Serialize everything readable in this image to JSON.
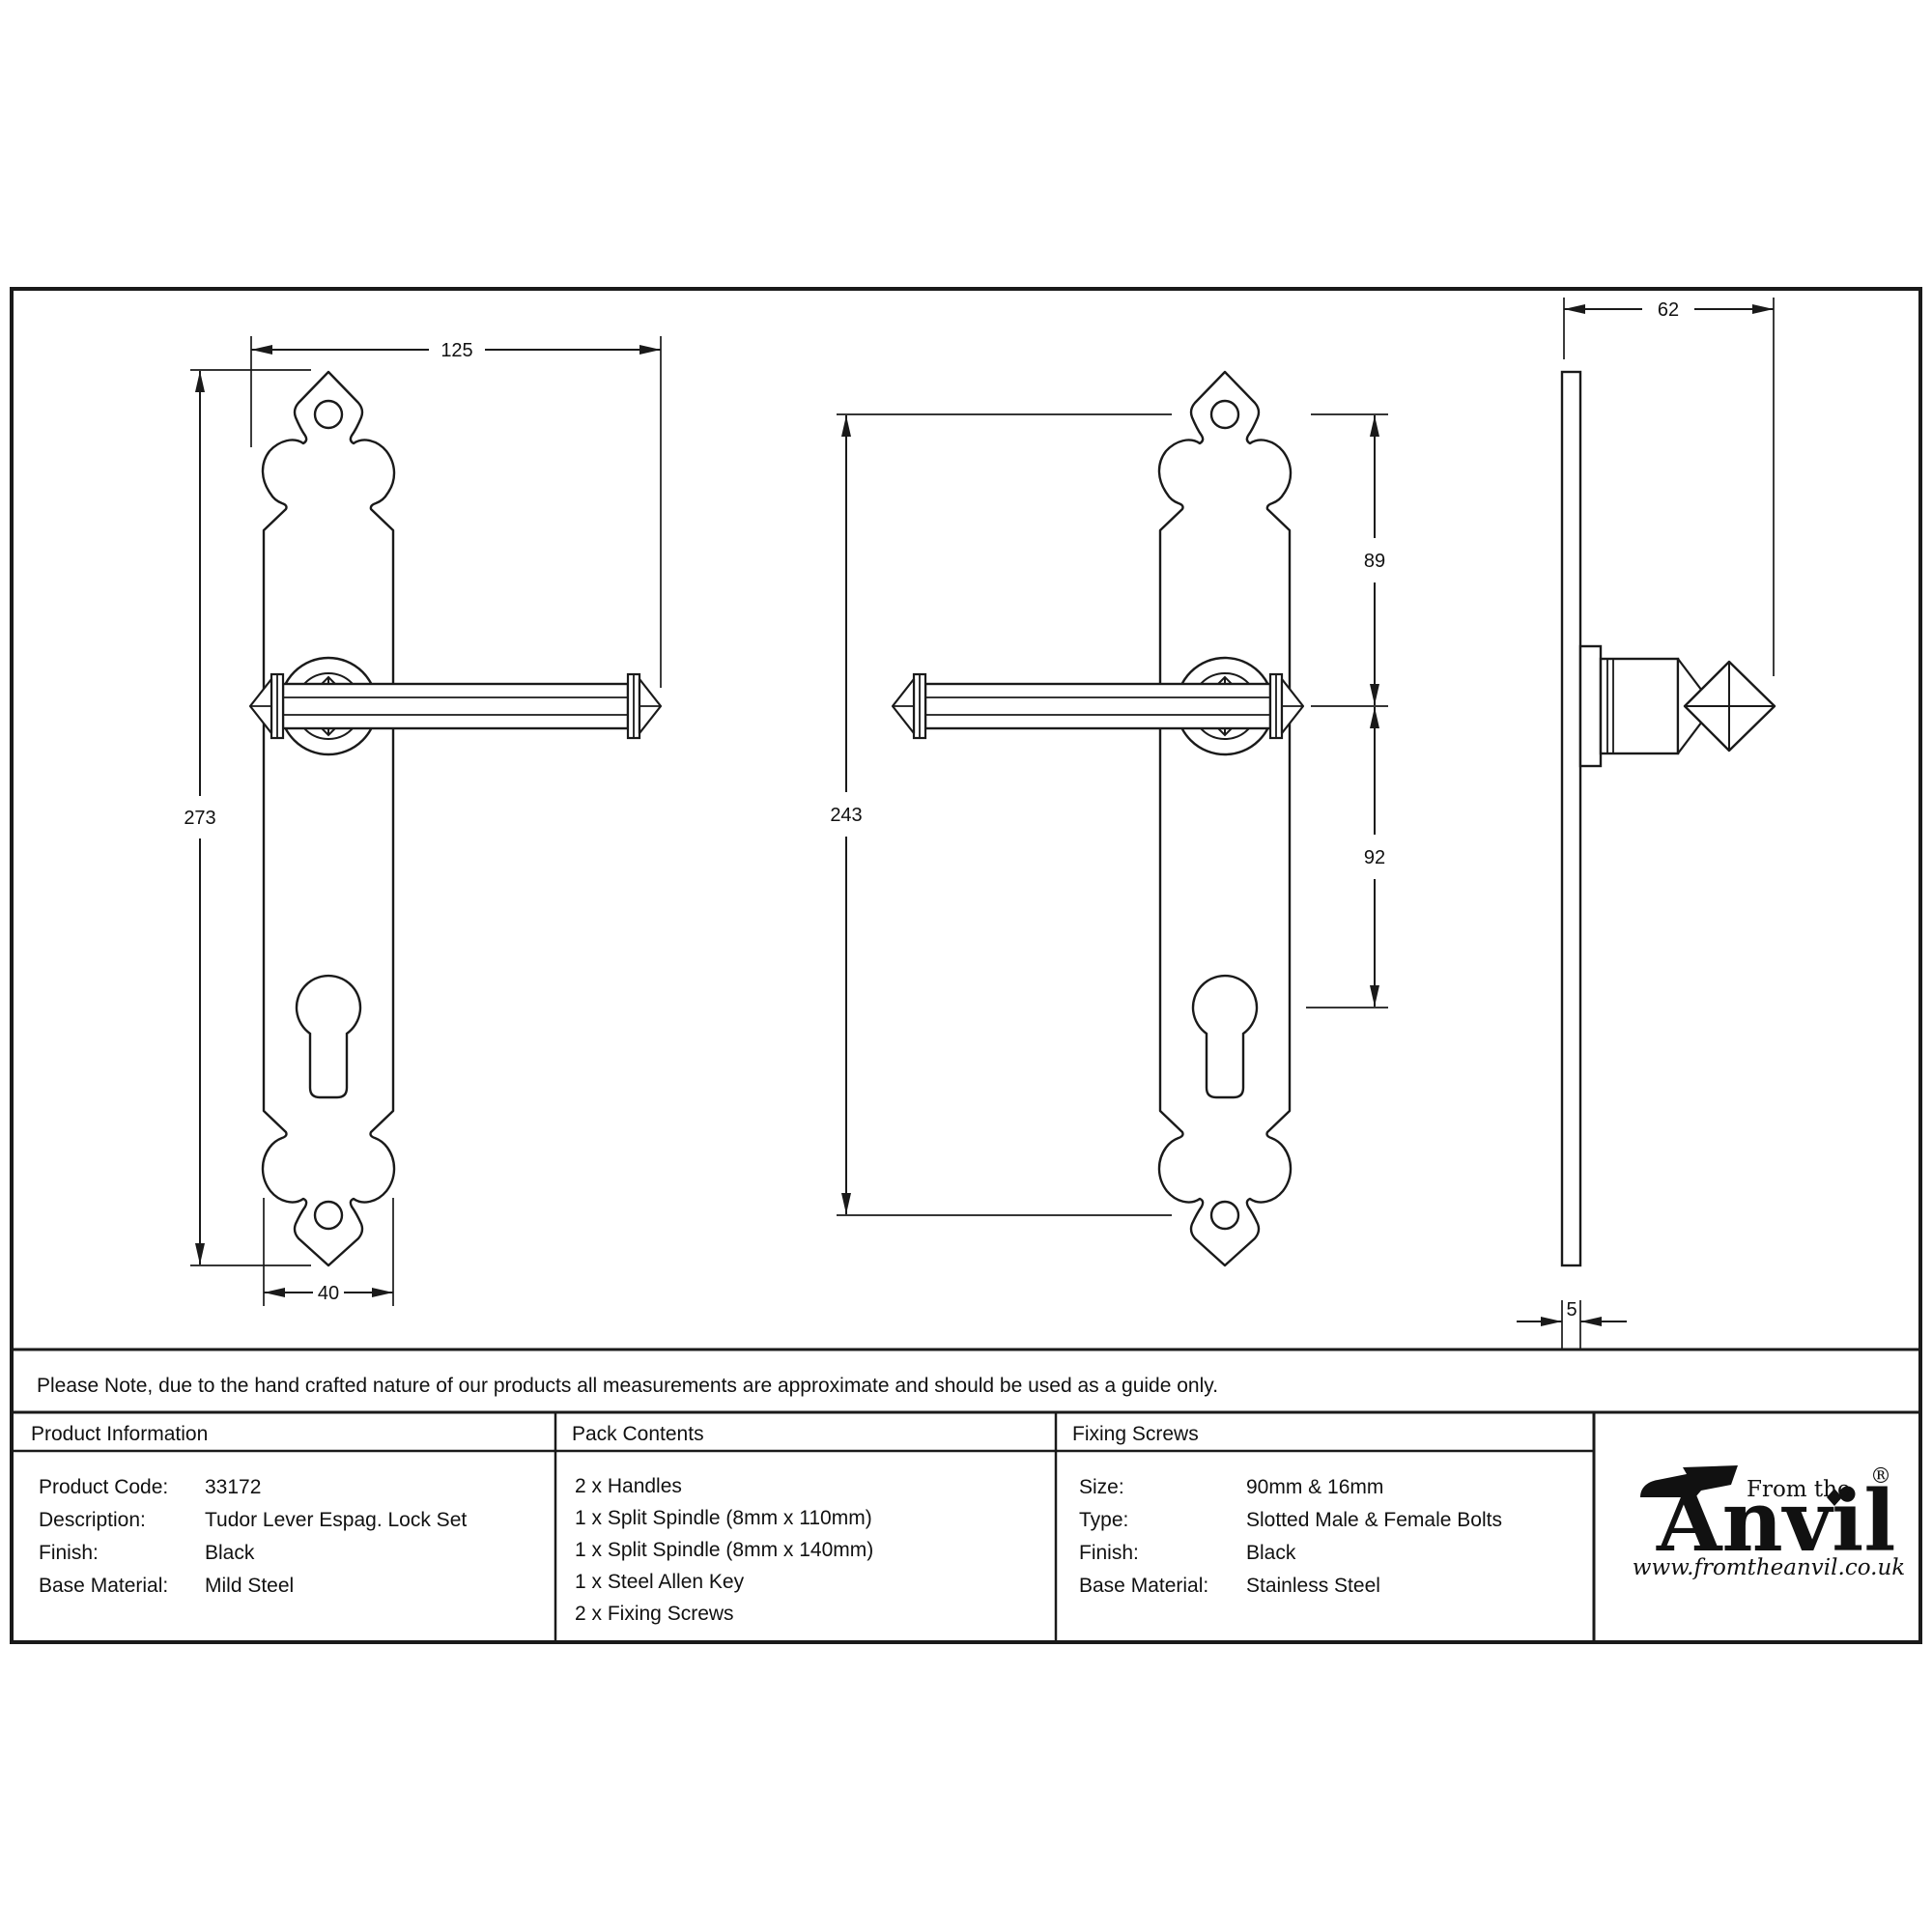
{
  "note": "Please Note, due to the hand crafted nature of our products all measurements are approximate and should be used as a guide only.",
  "dimensions": {
    "front_view": {
      "handle_length": "125",
      "plate_height": "273",
      "plate_width": "40"
    },
    "back_view": {
      "fixing_centres": "243",
      "top_to_spindle": "89",
      "spindle_to_keyhole": "92"
    },
    "side_view": {
      "projection": "62",
      "plate_thickness": "5"
    }
  },
  "table": {
    "product_information": {
      "title": "Product Information",
      "rows": [
        {
          "label": "Product Code:",
          "value": "33172"
        },
        {
          "label": "Description:",
          "value": "Tudor Lever Espag. Lock Set"
        },
        {
          "label": "Finish:",
          "value": "Black"
        },
        {
          "label": "Base Material:",
          "value": "Mild Steel"
        }
      ]
    },
    "pack_contents": {
      "title": "Pack Contents",
      "items": [
        "2 x Handles",
        "1 x Split Spindle (8mm x 110mm)",
        "1 x Split Spindle (8mm x 140mm)",
        "1 x Steel Allen Key",
        "2 x Fixing Screws"
      ]
    },
    "fixing_screws": {
      "title": "Fixing Screws",
      "rows": [
        {
          "label": "Size:",
          "value": "90mm & 16mm"
        },
        {
          "label": "Type:",
          "value": "Slotted Male & Female Bolts"
        },
        {
          "label": "Finish:",
          "value": "Black"
        },
        {
          "label": "Base Material:",
          "value": "Stainless Steel"
        }
      ]
    }
  },
  "logo": {
    "tagline": "From the",
    "brand": "Anvil",
    "registered": "®",
    "website": "www.fromtheanvil.co.uk"
  },
  "colors": {
    "line": "#1a1a1a",
    "text": "#111111",
    "background": "#ffffff"
  }
}
